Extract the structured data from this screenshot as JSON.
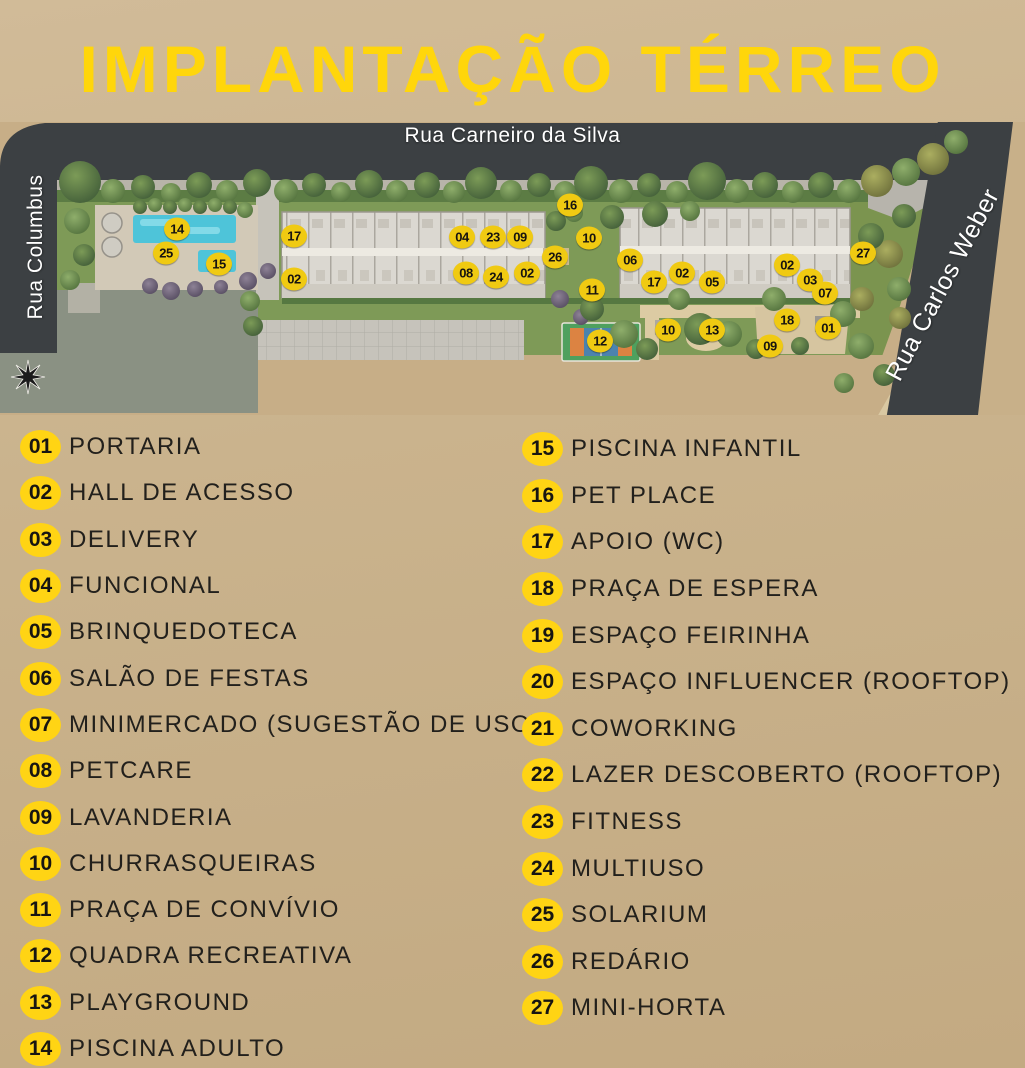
{
  "page": {
    "title": "IMPLANTAÇÃO TÉRREO",
    "colors": {
      "background_tan": "#C9B18B",
      "title_yellow": "#FFD60B",
      "badge_yellow": "#FFD414",
      "marker_yellow": "#F0CA12",
      "road_gray": "#3C4043",
      "legend_text": "#22201C"
    }
  },
  "map": {
    "streets": {
      "top": "Rua Carneiro da Silva",
      "left": "Rua Columbus",
      "right": "Rua Carlos Weber"
    },
    "markers": [
      {
        "n": "14",
        "x": 177,
        "y": 107
      },
      {
        "n": "25",
        "x": 166,
        "y": 131
      },
      {
        "n": "15",
        "x": 219,
        "y": 142
      },
      {
        "n": "17",
        "x": 294,
        "y": 114
      },
      {
        "n": "02",
        "x": 294,
        "y": 157
      },
      {
        "n": "04",
        "x": 462,
        "y": 115
      },
      {
        "n": "23",
        "x": 493,
        "y": 115
      },
      {
        "n": "09",
        "x": 520,
        "y": 115
      },
      {
        "n": "08",
        "x": 466,
        "y": 151
      },
      {
        "n": "24",
        "x": 496,
        "y": 155
      },
      {
        "n": "02",
        "x": 527,
        "y": 151
      },
      {
        "n": "16",
        "x": 570,
        "y": 83
      },
      {
        "n": "10",
        "x": 589,
        "y": 116
      },
      {
        "n": "26",
        "x": 555,
        "y": 135
      },
      {
        "n": "06",
        "x": 630,
        "y": 138
      },
      {
        "n": "11",
        "x": 592,
        "y": 168
      },
      {
        "n": "17",
        "x": 654,
        "y": 160
      },
      {
        "n": "02",
        "x": 682,
        "y": 151
      },
      {
        "n": "05",
        "x": 712,
        "y": 160
      },
      {
        "n": "02",
        "x": 787,
        "y": 143
      },
      {
        "n": "03",
        "x": 810,
        "y": 158
      },
      {
        "n": "07",
        "x": 825,
        "y": 171
      },
      {
        "n": "27",
        "x": 863,
        "y": 131
      },
      {
        "n": "18",
        "x": 787,
        "y": 198
      },
      {
        "n": "01",
        "x": 828,
        "y": 206
      },
      {
        "n": "10",
        "x": 668,
        "y": 208
      },
      {
        "n": "13",
        "x": 712,
        "y": 208
      },
      {
        "n": "09",
        "x": 770,
        "y": 224
      },
      {
        "n": "12",
        "x": 600,
        "y": 219
      }
    ]
  },
  "legend": {
    "columns": [
      {
        "items": [
          {
            "n": "01",
            "label": "PORTARIA"
          },
          {
            "n": "02",
            "label": "HALL DE ACESSO"
          },
          {
            "n": "03",
            "label": "DELIVERY"
          },
          {
            "n": "04",
            "label": "FUNCIONAL"
          },
          {
            "n": "05",
            "label": "BRINQUEDOTECA"
          },
          {
            "n": "06",
            "label": "SALÃO DE FESTAS"
          },
          {
            "n": "07",
            "label": "MINIMERCADO (SUGESTÃO DE USO)"
          },
          {
            "n": "08",
            "label": "PETCARE"
          },
          {
            "n": "09",
            "label": "LAVANDERIA"
          },
          {
            "n": "10",
            "label": "CHURRASQUEIRAS"
          },
          {
            "n": "11",
            "label": "PRAÇA DE CONVÍVIO"
          },
          {
            "n": "12",
            "label": "QUADRA RECREATIVA"
          },
          {
            "n": "13",
            "label": "PLAYGROUND"
          },
          {
            "n": "14",
            "label": "PISCINA ADULTO"
          }
        ]
      },
      {
        "items": [
          {
            "n": "15",
            "label": "PISCINA INFANTIL"
          },
          {
            "n": "16",
            "label": "PET PLACE"
          },
          {
            "n": "17",
            "label": "APOIO (WC)"
          },
          {
            "n": "18",
            "label": "PRAÇA DE ESPERA"
          },
          {
            "n": "19",
            "label": "ESPAÇO FEIRINHA"
          },
          {
            "n": "20",
            "label": "ESPAÇO INFLUENCER (ROOFTOP)"
          },
          {
            "n": "21",
            "label": "COWORKING"
          },
          {
            "n": "22",
            "label": "LAZER DESCOBERTO (ROOFTOP)"
          },
          {
            "n": "23",
            "label": "FITNESS"
          },
          {
            "n": "24",
            "label": "MULTIUSO"
          },
          {
            "n": "25",
            "label": "SOLARIUM"
          },
          {
            "n": "26",
            "label": "REDÁRIO"
          },
          {
            "n": "27",
            "label": "MINI-HORTA"
          }
        ]
      }
    ]
  }
}
